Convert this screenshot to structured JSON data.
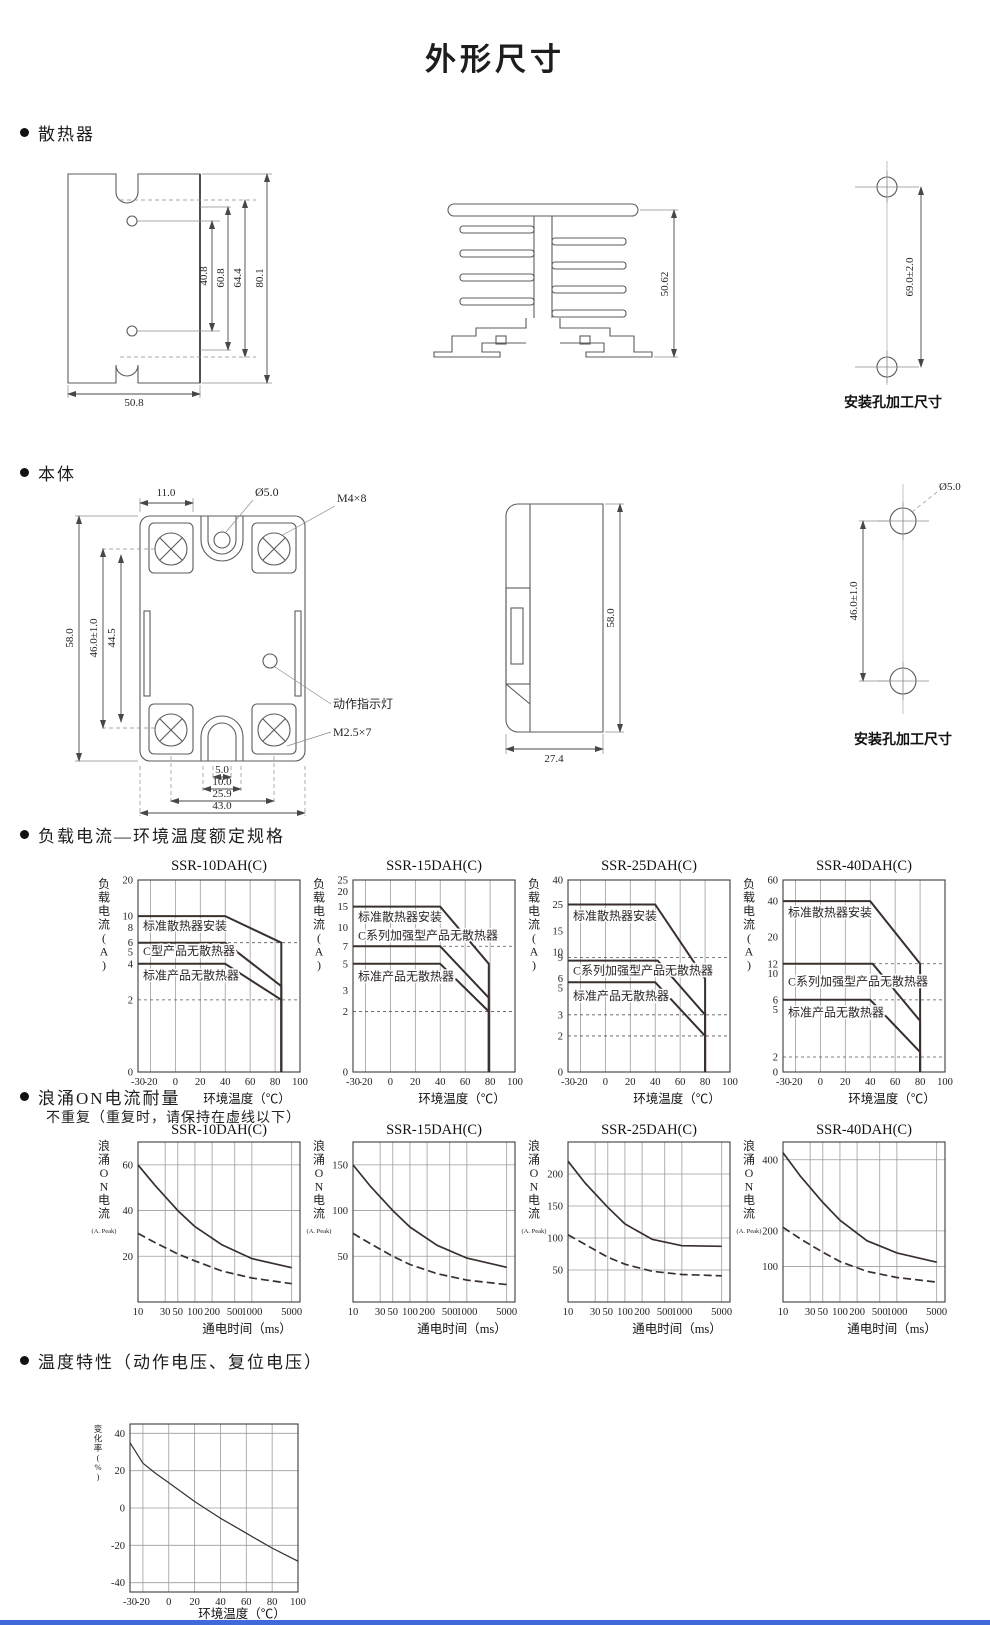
{
  "page_title": "外形尺寸",
  "colors": {
    "ink": "#1d1d1d",
    "curve": "#39302d",
    "grid": "#9d9d9d",
    "accent_bar": "#3f6ad8"
  },
  "sections": {
    "heatsink": {
      "label": "散热器"
    },
    "body": {
      "label": "本体"
    },
    "load": {
      "label": "负载电流—环境温度额定规格"
    },
    "surge": {
      "label": "浪涌ON电流耐量",
      "note": "不重复（重复时，请保持在虚线以下）"
    },
    "temp": {
      "label": "温度特性（动作电压、复位电压）"
    }
  },
  "drawings": {
    "heatsink_front": {
      "d80": "80.1",
      "d64": "64.4",
      "d60": "60.8",
      "d40": "40.8",
      "w": "50.8"
    },
    "heatsink_side": {
      "h": "50.62"
    },
    "heatsink_holes": {
      "pitch": "69.0±2.0",
      "caption": "安装孔加工尺寸"
    },
    "body_front": {
      "top_w": "11.0",
      "hole": "Ø5.0",
      "screw_top": "M4×8",
      "h": "58.0",
      "pitch": "46.0±1.0",
      "inner": "44.5",
      "indicator": "动作指示灯",
      "screw_bottom": "M2.5×7",
      "n5": "5.0",
      "n10": "10.0",
      "n25": "25.9",
      "n43": "43.0"
    },
    "body_side": {
      "h": "58.0",
      "w": "27.4"
    },
    "body_holes": {
      "hole": "Ø5.0",
      "pitch": "46.0±1.0",
      "caption": "安装孔加工尺寸"
    }
  },
  "chart_data": [
    {
      "group": "load",
      "type": "line",
      "title": "SSR-10DAH(C)",
      "ylabel": "负载电流(A)",
      "xlabel": "环境温度（℃）",
      "xscale": "linear",
      "yscale": "log",
      "xlim": [
        -30,
        100
      ],
      "ylim": [
        0,
        20
      ],
      "xticks": [
        -30,
        -20,
        0,
        20,
        40,
        60,
        80,
        100
      ],
      "yticks": [
        20,
        10,
        8,
        6,
        5,
        4,
        2,
        0
      ],
      "grid": "v",
      "guides": [
        6,
        2
      ],
      "series": [
        {
          "name": "标准散热器安装",
          "label_y": 8.3,
          "points": [
            [
              -30,
              10
            ],
            [
              40,
              10
            ],
            [
              85,
              6
            ],
            [
              85,
              0
            ]
          ]
        },
        {
          "name": "C型产品无散热器",
          "label_y": 5.1,
          "points": [
            [
              -30,
              6
            ],
            [
              40,
              6
            ],
            [
              85,
              2.6
            ],
            [
              85,
              0
            ]
          ]
        },
        {
          "name": "标准产品无散热器",
          "label_y": 3.2,
          "points": [
            [
              -30,
              4
            ],
            [
              40,
              4
            ],
            [
              85,
              2
            ],
            [
              85,
              0
            ]
          ]
        }
      ]
    },
    {
      "group": "load",
      "type": "line",
      "title": "SSR-15DAH(C)",
      "ylabel": "负载电流(A)",
      "xlabel": "环境温度（℃）",
      "xscale": "linear",
      "yscale": "log",
      "xlim": [
        -30,
        100
      ],
      "ylim": [
        0,
        25
      ],
      "xticks": [
        -30,
        -20,
        0,
        20,
        40,
        60,
        80,
        100
      ],
      "yticks": [
        25,
        20,
        15,
        10,
        7,
        5,
        3,
        2,
        0
      ],
      "grid": "v",
      "guides": [
        7,
        2
      ],
      "series": [
        {
          "name": "标准散热器安装",
          "label_y": 12.3,
          "points": [
            [
              -30,
              15
            ],
            [
              40,
              15
            ],
            [
              79,
              5
            ],
            [
              79,
              0
            ]
          ]
        },
        {
          "name": "C系列加强型产品无散热器",
          "label_y": 8.6,
          "points": [
            [
              -30,
              7
            ],
            [
              40,
              7
            ],
            [
              79,
              2.6
            ],
            [
              79,
              0
            ]
          ]
        },
        {
          "name": "标准产品无散热器",
          "label_y": 3.9,
          "points": [
            [
              -30,
              5
            ],
            [
              40,
              5
            ],
            [
              79,
              2
            ],
            [
              79,
              0
            ]
          ]
        }
      ]
    },
    {
      "group": "load",
      "type": "line",
      "title": "SSR-25DAH(C)",
      "ylabel": "负载电流(A)",
      "xlabel": "环境温度（℃）",
      "xscale": "linear",
      "yscale": "log",
      "xlim": [
        -30,
        100
      ],
      "ylim": [
        0,
        40
      ],
      "xticks": [
        -30,
        -20,
        0,
        20,
        40,
        60,
        80,
        100
      ],
      "yticks": [
        40,
        25,
        15,
        10,
        9,
        6,
        5,
        3,
        2,
        0
      ],
      "grid": "v",
      "guides": [
        9,
        3,
        2
      ],
      "series": [
        {
          "name": "标准散热器安装",
          "label_y": 20,
          "points": [
            [
              -30,
              25
            ],
            [
              40,
              25
            ],
            [
              80,
              6
            ],
            [
              80,
              0
            ]
          ]
        },
        {
          "name": "C系列加强型产品无散热器",
          "label_y": 7,
          "points": [
            [
              -30,
              8.5
            ],
            [
              42,
              8.5
            ],
            [
              80,
              3
            ],
            [
              80,
              0
            ]
          ]
        },
        {
          "name": "标准产品无散热器",
          "label_y": 4.3,
          "points": [
            [
              -30,
              5.6
            ],
            [
              40,
              5.6
            ],
            [
              80,
              2
            ],
            [
              80,
              0
            ]
          ]
        }
      ]
    },
    {
      "group": "load",
      "type": "line",
      "title": "SSR-40DAH(C)",
      "ylabel": "负载电流(A)",
      "xlabel": "环境温度（℃）",
      "xscale": "linear",
      "yscale": "log",
      "xlim": [
        -30,
        100
      ],
      "ylim": [
        0,
        60
      ],
      "xticks": [
        -30,
        -20,
        0,
        20,
        40,
        60,
        80,
        100
      ],
      "yticks": [
        60,
        40,
        20,
        12,
        10,
        6,
        5,
        2,
        0
      ],
      "grid": "v",
      "guides": [
        12,
        6,
        2
      ],
      "series": [
        {
          "name": "标准散热器安装",
          "label_y": 32,
          "points": [
            [
              -30,
              40
            ],
            [
              40,
              40
            ],
            [
              80,
              12
            ],
            [
              80,
              0
            ]
          ]
        },
        {
          "name": "C系列加强型产品无散热器",
          "label_y": 8.5,
          "points": [
            [
              -30,
              12
            ],
            [
              42,
              12
            ],
            [
              80,
              4
            ],
            [
              80,
              0
            ]
          ]
        },
        {
          "name": "标准产品无散热器",
          "label_y": 4.7,
          "points": [
            [
              -30,
              6
            ],
            [
              40,
              6
            ],
            [
              80,
              2.2
            ],
            [
              80,
              0
            ]
          ]
        }
      ]
    },
    {
      "group": "surge",
      "type": "line",
      "title": "SSR-10DAH(C)",
      "ylabel": "浪涌ON电流",
      "ylabel_sub": "(A. Peak)",
      "xlabel": "通电时间（ms）",
      "xscale": "log",
      "yscale": "linear",
      "xlim": [
        10,
        7000
      ],
      "ylim": [
        0,
        70
      ],
      "xticks": [
        10,
        30,
        50,
        100,
        200,
        500,
        1000,
        5000
      ],
      "yticks": [
        60,
        40,
        20
      ],
      "grid": "both",
      "series": [
        {
          "points": [
            [
              10,
              60
            ],
            [
              20,
              51
            ],
            [
              50,
              40
            ],
            [
              100,
              33
            ],
            [
              300,
              25
            ],
            [
              1000,
              19
            ],
            [
              5000,
              15
            ]
          ]
        },
        {
          "dash": true,
          "points": [
            [
              10,
              30
            ],
            [
              20,
              26
            ],
            [
              50,
              21
            ],
            [
              100,
              18
            ],
            [
              300,
              13.5
            ],
            [
              1000,
              10.5
            ],
            [
              5000,
              8
            ]
          ]
        }
      ]
    },
    {
      "group": "surge",
      "type": "line",
      "title": "SSR-15DAH(C)",
      "ylabel": "浪涌ON电流",
      "ylabel_sub": "(A. Peak)",
      "xlabel": "通电时间（ms）",
      "xscale": "log",
      "yscale": "linear",
      "xlim": [
        10,
        7000
      ],
      "ylim": [
        0,
        175
      ],
      "xticks": [
        10,
        30,
        50,
        100,
        200,
        500,
        1000,
        5000
      ],
      "yticks": [
        150,
        100,
        50
      ],
      "grid": "both",
      "series": [
        {
          "points": [
            [
              10,
              150
            ],
            [
              20,
              127
            ],
            [
              50,
              100
            ],
            [
              100,
              82
            ],
            [
              300,
              62
            ],
            [
              1000,
              48
            ],
            [
              5000,
              38
            ]
          ]
        },
        {
          "dash": true,
          "points": [
            [
              10,
              75
            ],
            [
              20,
              64
            ],
            [
              50,
              50
            ],
            [
              100,
              41
            ],
            [
              300,
              31
            ],
            [
              1000,
              24
            ],
            [
              5000,
              19
            ]
          ]
        }
      ]
    },
    {
      "group": "surge",
      "type": "line",
      "title": "SSR-25DAH(C)",
      "ylabel": "浪涌ON电流",
      "ylabel_sub": "(A. Peak)",
      "xlabel": "通电时间（ms）",
      "xscale": "log",
      "yscale": "linear",
      "xlim": [
        10,
        7000
      ],
      "ylim": [
        0,
        250
      ],
      "xticks": [
        10,
        30,
        50,
        100,
        200,
        500,
        1000,
        5000
      ],
      "yticks": [
        200,
        150,
        100,
        50
      ],
      "grid": "both",
      "series": [
        {
          "points": [
            [
              10,
              220
            ],
            [
              20,
              186
            ],
            [
              50,
              148
            ],
            [
              100,
              122
            ],
            [
              300,
              98
            ],
            [
              1000,
              88
            ],
            [
              5000,
              87
            ]
          ]
        },
        {
          "dash": true,
          "points": [
            [
              10,
              105
            ],
            [
              20,
              90
            ],
            [
              50,
              70
            ],
            [
              100,
              59
            ],
            [
              300,
              48
            ],
            [
              1000,
              43
            ],
            [
              5000,
              41
            ]
          ]
        }
      ]
    },
    {
      "group": "surge",
      "type": "line",
      "title": "SSR-40DAH(C)",
      "ylabel": "浪涌ON电流",
      "ylabel_sub": "(A. Peak)",
      "xlabel": "通电时间（ms）",
      "xscale": "log",
      "yscale": "linear",
      "xlim": [
        10,
        7000
      ],
      "ylim": [
        0,
        450
      ],
      "xticks": [
        10,
        30,
        50,
        100,
        200,
        500,
        1000,
        5000
      ],
      "yticks": [
        400,
        200,
        100
      ],
      "grid": "both",
      "series": [
        {
          "points": [
            [
              10,
              420
            ],
            [
              20,
              355
            ],
            [
              50,
              280
            ],
            [
              100,
              230
            ],
            [
              300,
              172
            ],
            [
              1000,
              138
            ],
            [
              5000,
              112
            ]
          ]
        },
        {
          "dash": true,
          "points": [
            [
              10,
              210
            ],
            [
              20,
              178
            ],
            [
              50,
              140
            ],
            [
              100,
              114
            ],
            [
              300,
              86
            ],
            [
              1000,
              69
            ],
            [
              5000,
              56
            ]
          ]
        }
      ]
    },
    {
      "group": "temp",
      "type": "line",
      "title": "",
      "ylabel": "变化率(%)",
      "xlabel": "环境温度（℃）",
      "xscale": "linear",
      "yscale": "linear",
      "xlim": [
        -30,
        100
      ],
      "ylim": [
        -45,
        45
      ],
      "xticks": [
        -30,
        -20,
        0,
        20,
        40,
        60,
        80,
        100
      ],
      "yticks": [
        40,
        20,
        0,
        -20,
        -40
      ],
      "grid": "both",
      "series": [
        {
          "points": [
            [
              -30,
              35
            ],
            [
              -20,
              24
            ],
            [
              -10,
              18.5
            ],
            [
              0,
              13.5
            ],
            [
              10,
              8.5
            ],
            [
              20,
              3.5
            ],
            [
              30,
              -1
            ],
            [
              40,
              -5.5
            ],
            [
              50,
              -9.5
            ],
            [
              60,
              -13.5
            ],
            [
              70,
              -17.5
            ],
            [
              80,
              -21.5
            ],
            [
              90,
              -25
            ],
            [
              100,
              -28.5
            ]
          ]
        }
      ]
    }
  ]
}
